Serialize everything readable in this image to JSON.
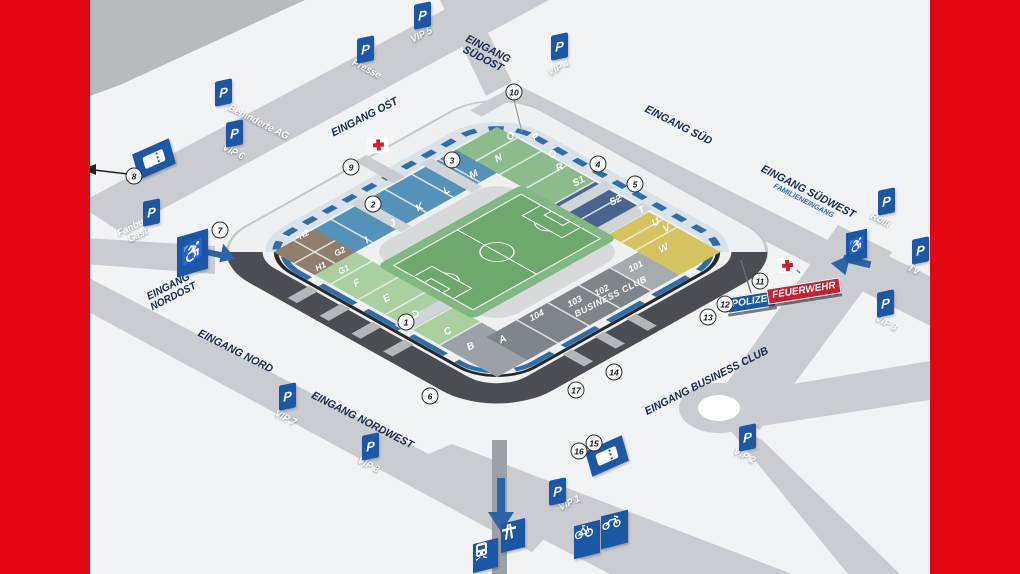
{
  "colors": {
    "accent_red": "#e30613",
    "sign_blue": "#1c57a5",
    "label_navy": "#17294d",
    "feuerwehr_red": "#c42233",
    "pitch_green": "#6da96d",
    "family_blue": "#2a6fb5"
  },
  "entrances": {
    "ost": "EINGANG OST",
    "suedost_line1": "EINGANG",
    "suedost_line2": "SÜDOST",
    "sued": "EINGANG SÜD",
    "suedwest": "EINGANG SÜDWEST",
    "suedwest_sub": "FAMILIENEINGANG",
    "nordost_line1": "EINGANG",
    "nordost_line2": "NORDOST",
    "nord": "EINGANG NORD",
    "nordwest": "EINGANG NORDWEST",
    "business": "EINGANG BUSINESS CLUB"
  },
  "parking": {
    "symbol": "P",
    "presse": "Presse",
    "behinderte_ag": "Behinderte AG",
    "vip1": "VIP 1",
    "vip2": "VIP 2",
    "vip3": "VIP 3",
    "vip4": "VIP 4",
    "vip5": "VIP 5",
    "vip6": "VIP 6",
    "vip7": "VIP 7",
    "vip8": "VIP 8",
    "rolli": "Rolli",
    "tv": "TV",
    "fanbus_line1": "Fanbus",
    "fanbus_line2": "Gast"
  },
  "services": {
    "polizei": "POLIZEI",
    "feuerwehr": "FEUERWEHR"
  },
  "stadium": {
    "business_club": "BUSINESS CLUB",
    "sections": {
      "north": [
        "A",
        "B",
        "C",
        "D",
        "E",
        "F"
      ],
      "corner_north": [
        "G1",
        "G2",
        "H1",
        "H2"
      ],
      "east": [
        "I",
        "J",
        "K",
        "L",
        "M",
        "N"
      ],
      "south": [
        "O",
        "P",
        "Q",
        "R"
      ],
      "guest": [
        "S1",
        "S2"
      ],
      "southwest": [
        "T",
        "U",
        "V"
      ],
      "west": [
        "W"
      ],
      "business": [
        "101",
        "102",
        "103",
        "104"
      ]
    }
  },
  "gates": [
    "1",
    "2",
    "3",
    "4",
    "5",
    "6",
    "7",
    "8",
    "9",
    "10",
    "11",
    "12",
    "13",
    "14",
    "15",
    "16",
    "17"
  ]
}
